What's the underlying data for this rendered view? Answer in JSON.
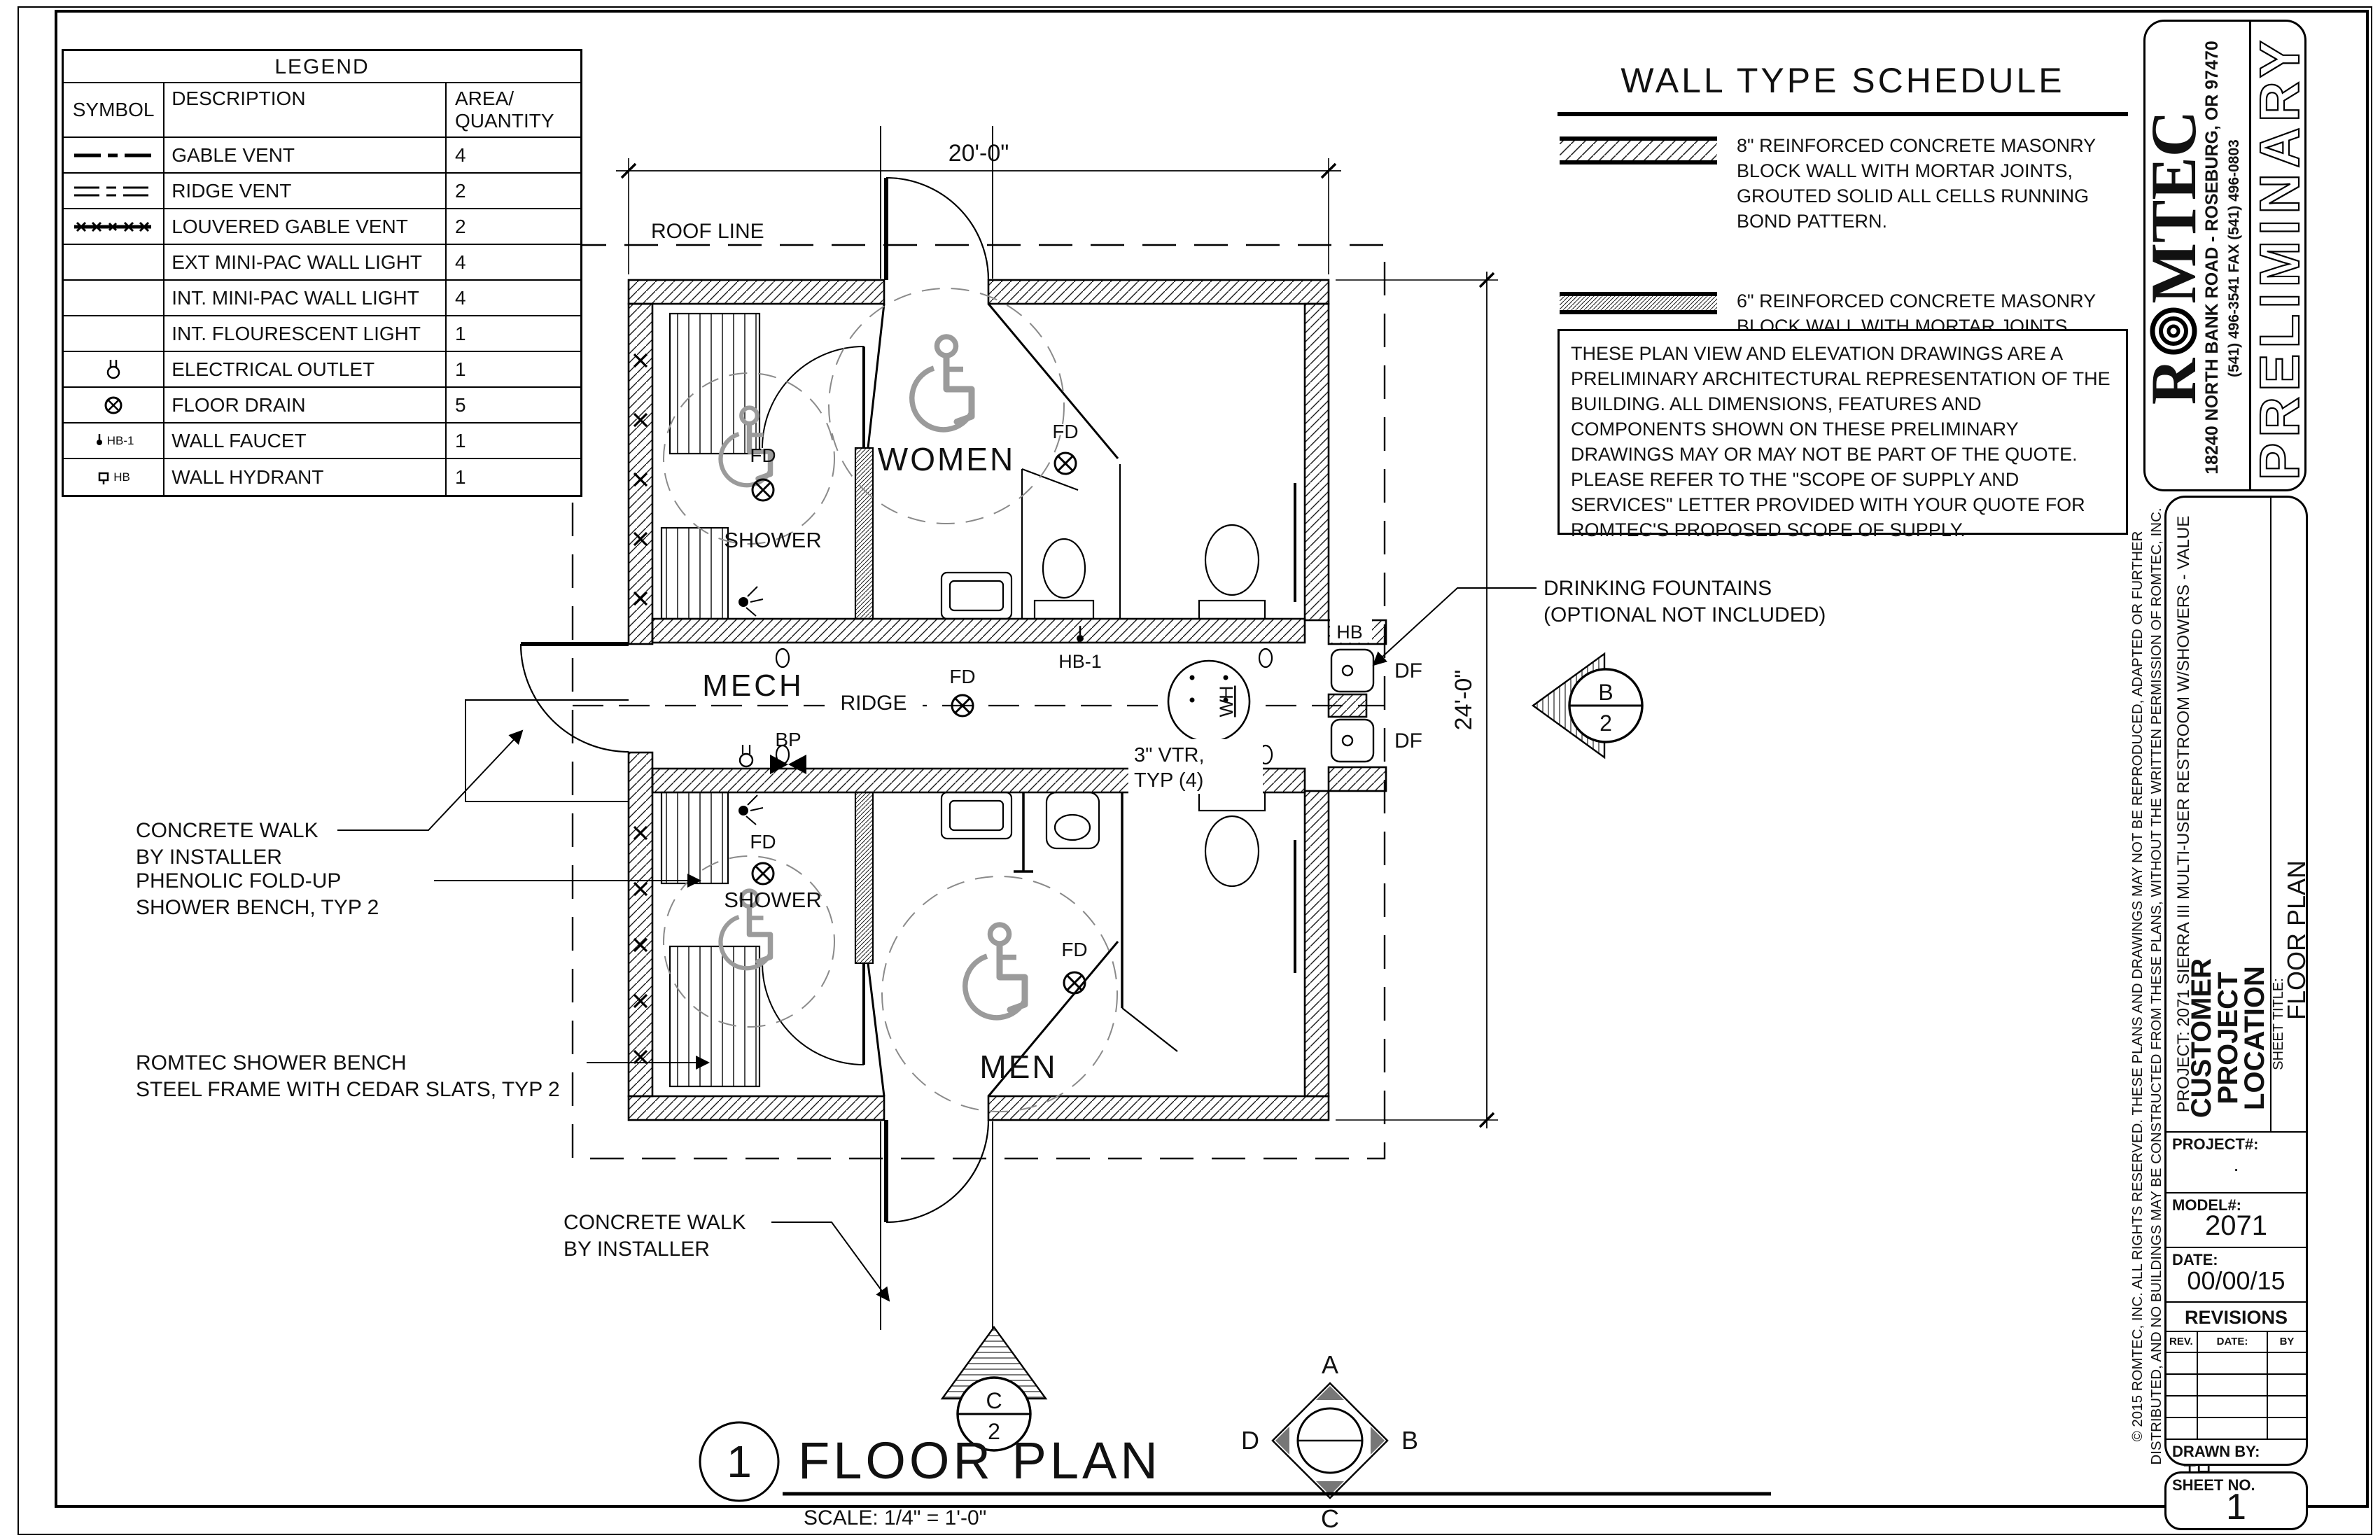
{
  "legend": {
    "title": "LEGEND",
    "headers": {
      "symbol": "SYMBOL",
      "description": "DESCRIPTION",
      "area_line1": "AREA/",
      "area_line2": "QUANTITY"
    },
    "rows": [
      {
        "symbol": "gable-vent-line",
        "label": "",
        "description": "GABLE VENT",
        "qty": "4"
      },
      {
        "symbol": "ridge-vent-line",
        "label": "",
        "description": "RIDGE VENT",
        "qty": "2"
      },
      {
        "symbol": "louvered-gable-vent-line",
        "label": "",
        "description": "LOUVERED GABLE VENT",
        "qty": "2"
      },
      {
        "symbol": "none",
        "label": "",
        "description": "EXT MINI-PAC WALL LIGHT",
        "qty": "4"
      },
      {
        "symbol": "none",
        "label": "",
        "description": "INT. MINI-PAC WALL LIGHT",
        "qty": "4"
      },
      {
        "symbol": "none",
        "label": "",
        "description": "INT. FLOURESCENT LIGHT",
        "qty": "1"
      },
      {
        "symbol": "electrical-outlet",
        "label": "",
        "description": "ELECTRICAL OUTLET",
        "qty": "1"
      },
      {
        "symbol": "floor-drain",
        "label": "",
        "description": "FLOOR DRAIN",
        "qty": "5"
      },
      {
        "symbol": "wall-faucet",
        "label": "HB-1",
        "description": "WALL FAUCET",
        "qty": "1"
      },
      {
        "symbol": "wall-hydrant",
        "label": "HB",
        "description": "WALL HYDRANT",
        "qty": "1"
      }
    ]
  },
  "wall_schedule": {
    "title": "WALL TYPE SCHEDULE",
    "items": [
      {
        "swatch": "8-inch-cmu-hatch",
        "text": "8\" REINFORCED CONCRETE MASONRY BLOCK WALL WITH MORTAR JOINTS, GROUTED SOLID ALL CELLS RUNNING BOND PATTERN."
      },
      {
        "swatch": "6-inch-cmu-hatch",
        "text": "6\" REINFORCED CONCRETE MASONRY BLOCK WALL WITH MORTAR JOINTS, GROUTED SOLID ALL CELLS RUNNING BOND PATTERN."
      }
    ]
  },
  "notes": {
    "text": "THESE PLAN VIEW AND ELEVATION DRAWINGS ARE A PRELIMINARY ARCHITECTURAL REPRESENTATION OF THE BUILDING. ALL DIMENSIONS, FEATURES AND COMPONENTS SHOWN ON THESE PRELIMINARY DRAWINGS MAY OR MAY NOT BE PART OF THE QUOTE. PLEASE REFER TO THE \"SCOPE OF SUPPLY AND SERVICES\" LETTER PROVIDED WITH YOUR QUOTE FOR ROMTEC'S PROPOSED SCOPE OF SUPPLY."
  },
  "plan": {
    "rooms": {
      "women": "WOMEN",
      "men": "MEN",
      "mech": "MECH",
      "shower_women": "SHOWER",
      "shower_men": "SHOWER"
    },
    "labels": {
      "roof_line": "ROOF LINE",
      "ridge": "RIDGE",
      "fd": "FD",
      "hb1": "HB-1",
      "hb": "HB",
      "df": "DF",
      "bp": "BP",
      "wh": "WH",
      "vtr_line1": "3\" VTR,",
      "vtr_line2": "TYP (4)"
    },
    "dims": {
      "width": "20'-0\"",
      "height": "24'-0\""
    },
    "callouts": {
      "concrete_walk_line1": "CONCRETE WALK",
      "concrete_walk_line2": "BY INSTALLER",
      "phenolic_line1": "PHENOLIC FOLD-UP",
      "phenolic_line2": "SHOWER BENCH, TYP 2",
      "romtec_bench_line1": "ROMTEC SHOWER BENCH",
      "romtec_bench_line2": "STEEL FRAME WITH CEDAR SLATS, TYP 2",
      "drinking_line1": "DRINKING FOUNTAINS",
      "drinking_line2": "(OPTIONAL NOT INCLUDED)"
    },
    "markers": {
      "compass_a": "A",
      "compass_b": "B",
      "compass_c": "C",
      "compass_d": "D",
      "section_c_top": "C",
      "section_c_bottom": "2",
      "section_b_top": "B",
      "section_b_bottom": "2"
    },
    "title": {
      "number": "1",
      "name": "FLOOR PLAN",
      "scale": "SCALE: 1/4\" = 1'-0\""
    }
  },
  "titleblock": {
    "logo_prefix": "R",
    "logo_suffix": "MTEC",
    "address": "18240 NORTH BANK ROAD - ROSEBURG, OR 97470",
    "phone": "(541) 496-3541    FAX (541) 496-0803",
    "preliminary": "PRELIMINARY",
    "copyright_line1": "© 2015 ROMTEC, INC.  ALL RIGHTS RESERVED.  THESE PLANS AND DRAWINGS MAY NOT BE REPRODUCED, ADAPTED OR FURTHER",
    "copyright_line2": "DISTRIBUTED, AND NO BUILDINGS MAY BE CONSTRUCTED FROM THESE PLANS, WITHOUT THE WRITTEN PERMISSION OF ROMTEC, INC.",
    "project_line": "PROJECT: 2071 SIERRA III MULTI-USER RESTROOM W/SHOWERS - VALUE",
    "customer_line1": "CUSTOMER",
    "customer_line2": "PROJECT",
    "customer_line3": "LOCATION",
    "sheet_title_label": "SHEET TITLE:",
    "sheet_title": "FLOOR PLAN",
    "project_no_label": "PROJECT#:",
    "project_no_value": ".",
    "model_label": "MODEL#:",
    "model_value": "2071",
    "date_label": "DATE:",
    "date_value": "00/00/15",
    "revisions_title": "REVISIONS",
    "rev_headers": {
      "rev": "REV.",
      "date": "DATE:",
      "by": "BY"
    },
    "drawn_by_label": "DRAWN BY:",
    "drawn_by_value": "TH",
    "sheet_no_label": "SHEET NO.",
    "sheet_no_value": "1"
  }
}
